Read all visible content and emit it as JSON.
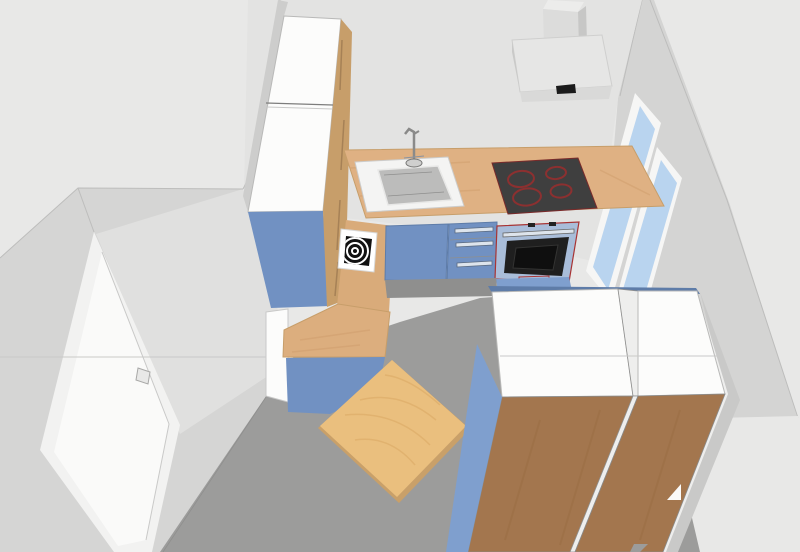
{
  "scene": {
    "type": "3d-kitchen-room-render",
    "view": "elevated corner perspective looking into room",
    "visible_text": ""
  },
  "objects": {
    "room": {
      "walls": 3,
      "door_count": 1,
      "window_pane_count": 2
    },
    "door": {
      "name": "entrance-door",
      "color_key": "door_frame"
    },
    "window": {
      "name": "two-pane-window",
      "panes": 2
    },
    "tall_cabinet": {
      "name": "tall-cabinet",
      "doors": 2
    },
    "side_icon": {
      "name": "spiral-target-icon",
      "rings": 3
    },
    "counter": {
      "name": "kitchen-counter-run"
    },
    "sink": {
      "name": "sink-with-faucet"
    },
    "cooktop": {
      "name": "cooktop",
      "burners": 4
    },
    "oven": {
      "name": "built-in-oven"
    },
    "drawer_unit": {
      "name": "drawer-unit",
      "drawers": 3
    },
    "hood": {
      "name": "range-hood"
    },
    "peninsula": {
      "name": "peninsula-counter"
    },
    "table": {
      "name": "wooden-table"
    },
    "wardrobes": {
      "name": "tall-wardrobe-units",
      "count": 2
    }
  },
  "palette": {
    "background": "#e8e8e7",
    "back_wall": "#e3e3e2",
    "right_wall": "#d4d4d3",
    "right_wall_shadow": "#c9c9c8",
    "left_wall": "#d5d5d4",
    "left_wall_light": "#e0e0df",
    "floor": "#9c9c9b",
    "door_frame": "#f2f2f1",
    "door_panel": "#fafaf9",
    "door_handle": "#e8e8e7",
    "window_frame": "#f6f6f5",
    "window_glass": "#b9d4ef",
    "counter_wood": "#dfb183",
    "wood_grain": "#d09f6d",
    "cabinet_edge_wood": "#c79e6a",
    "edge_wood_dark": "#8a6a45",
    "side_panel_wood": "#d9ab7a",
    "l_top_wood": "#dcae7e",
    "cabinet_blue": "#7191c2",
    "cabinet_blue_light": "#7f9fce",
    "cabinet_blue_dark": "#5e7ca8",
    "plinth_blue": "#6583b2",
    "white_surface": "#fcfcfb",
    "gap_white": "#eeeeed",
    "unit_brown": "#a3764e",
    "brown_streak": "#96693f",
    "table_wood": "#eabf7e",
    "table_grain": "#d8a763",
    "table_edge": "#c9a069",
    "hood_top": "#e6e6e5",
    "hood_front": "#d9d9d8",
    "hood_side": "#c9c9c8",
    "chimney_front": "#dcdcdb",
    "chimney_top": "#ececeb",
    "chimney_side": "#c7c7c6",
    "vent_black": "#1b1b1b",
    "cooktop_black": "#3f3f3f",
    "burner_ring": "#8c3030",
    "oven_frame": "#a9bdd9",
    "oven_trim_red": "#a83434",
    "oven_door": "#1f1f1f",
    "oven_door_inner": "#0f0f0f",
    "chrome": "#dde4ec",
    "sink_surround": "#f4f4f3",
    "sink_basin": "#bcbcbb",
    "faucet_gray": "#cfcfce",
    "icon_white": "#ffffff",
    "icon_black": "#121212",
    "shadow_gray": "#8f8f8e",
    "corner_sliver": "#cdcdcc"
  }
}
